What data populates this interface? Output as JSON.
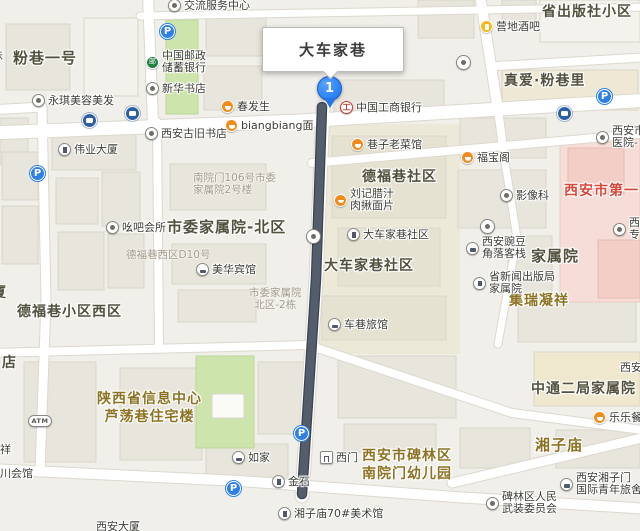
{
  "map": {
    "callout": {
      "text": "大车家巷"
    },
    "marker": {
      "number": "1"
    },
    "colors": {
      "route": "#535d6b",
      "marker_blue": "#2f86f6",
      "parking_blue": "#2f7fe8",
      "bus_blue": "#2c5fa4",
      "food_orange": "#f08c1e",
      "beer_yellow": "#f3b91d",
      "icbc_red": "#c23b31",
      "psbc_green": "#1e7f3e",
      "area_dark": "#53513e",
      "area_gold": "#8d7424",
      "hospital_red": "#d6473c",
      "addr_gray": "#a29c90",
      "park_green": "#cde4ad",
      "hospital_pink": "#f7ddd7"
    },
    "areas": [
      {
        "name": "fenxiang-yihao",
        "style": "dark",
        "size": 15,
        "x": 13,
        "y": 49,
        "lines": [
          "粉巷一号"
        ]
      },
      {
        "name": "sheng-chubanshe-xiaoqu",
        "style": "dark",
        "size": 14,
        "x": 542,
        "y": 4,
        "lines": [
          "省出版社小区"
        ]
      },
      {
        "name": "zhenai-fenxiangli",
        "style": "dark",
        "size": 14,
        "x": 504,
        "y": 73,
        "lines": [
          "真爱·粉巷里"
        ]
      },
      {
        "name": "defuxiang-shequ",
        "style": "dark",
        "size": 14,
        "x": 362,
        "y": 169,
        "lines": [
          "德福巷社区"
        ]
      },
      {
        "name": "shiwei-jiashuyuan-beiqu",
        "style": "dark",
        "size": 15,
        "x": 167,
        "y": 218,
        "lines": [
          "市委家属院-北区"
        ]
      },
      {
        "name": "defuxiang-xiaoqu-xiqu",
        "style": "dark",
        "size": 14,
        "x": 17,
        "y": 304,
        "lines": [
          "德福巷小区西区"
        ]
      },
      {
        "name": "dachejiaxiang-shequ",
        "style": "dark",
        "size": 14,
        "x": 324,
        "y": 258,
        "lines": [
          "大车家巷社区"
        ]
      },
      {
        "name": "jiashuyuan",
        "style": "dark",
        "size": 15,
        "x": 531,
        "y": 247,
        "lines": [
          "家属院"
        ]
      },
      {
        "name": "jirui-ningxiang",
        "style": "gold",
        "size": 14,
        "x": 509,
        "y": 293,
        "lines": [
          "集瑞凝祥"
        ]
      },
      {
        "name": "shanxisheng-xinxi-zhongxin",
        "style": "gold",
        "size": 14,
        "x": 97,
        "y": 391,
        "align": "center",
        "lines": [
          "陕西省信息中心",
          "芦荡巷住宅楼"
        ]
      },
      {
        "name": "beilinqu-youeryuan",
        "style": "gold",
        "size": 14,
        "x": 362,
        "y": 448,
        "lines": [
          "西安市碑林区",
          "南院门幼儿园"
        ]
      },
      {
        "name": "xiangzimiao",
        "style": "gold",
        "size": 15,
        "x": 535,
        "y": 436,
        "lines": [
          "湘子庙"
        ]
      },
      {
        "name": "zhongtong-erju-jiashuyuan",
        "style": "dark",
        "size": 14,
        "x": 531,
        "y": 381,
        "lines": [
          "中通二局家属院"
        ]
      },
      {
        "name": "xianshi-diyi-yiyuan",
        "style": "red",
        "size": 14,
        "x": 564,
        "y": 183,
        "lines": [
          "西安市第一"
        ]
      },
      {
        "name": "sha-partial",
        "style": "dark",
        "size": 14,
        "x": -8,
        "y": 285,
        "lines": [
          "厦"
        ]
      },
      {
        "name": "dian-partial",
        "style": "dark",
        "size": 14,
        "x": 2,
        "y": 355,
        "lines": [
          "店"
        ]
      }
    ],
    "pois": [
      {
        "name": "jiaoliu-fuwu-zhongxin",
        "icon": "dot",
        "x": 168,
        "y": -1,
        "lines": [
          "交流服务中心"
        ]
      },
      {
        "name": "zhongguo-youzheng-chuxu-yinhang",
        "icon": "bank-psbc",
        "x": 146,
        "y": 50,
        "lines": [
          "中国邮政",
          "储蓄银行"
        ]
      },
      {
        "name": "xinhua-shudian",
        "icon": "dot",
        "x": 146,
        "y": 82,
        "lines": [
          "新华书店"
        ]
      },
      {
        "name": "yongqi-meirong-meifa",
        "icon": "dot",
        "x": 32,
        "y": 94,
        "lines": [
          "永琪美容美发"
        ]
      },
      {
        "name": "chunfasheng",
        "icon": "food",
        "x": 221,
        "y": 100,
        "lines": [
          "春发生"
        ]
      },
      {
        "name": "biangbiang-mian",
        "icon": "food",
        "x": 225,
        "y": 119,
        "lines": [
          "biangbiang面"
        ]
      },
      {
        "name": "xian-gujiu-shudian",
        "icon": "dot",
        "x": 145,
        "y": 127,
        "lines": [
          "西安古旧书店"
        ]
      },
      {
        "name": "weiye-dasha",
        "icon": "bldg",
        "x": 58,
        "y": 143,
        "lines": [
          "伟业大厦"
        ]
      },
      {
        "name": "yingdi-jiuba",
        "icon": "beer",
        "x": 480,
        "y": 20,
        "lines": [
          "营地酒吧"
        ]
      },
      {
        "name": "zhongguo-gongshang-yinhang",
        "icon": "bank-icbc",
        "x": 340,
        "y": 101,
        "lines": [
          "中国工商银行"
        ]
      },
      {
        "name": "xiangzi-laocaiguan",
        "icon": "food",
        "x": 351,
        "y": 138,
        "lines": [
          "巷子老菜馆"
        ]
      },
      {
        "name": "fubaoge",
        "icon": "food",
        "x": 461,
        "y": 151,
        "lines": [
          "福宝阁"
        ]
      },
      {
        "name": "liuji-lazhi-roujiu-mianpian",
        "icon": "food",
        "x": 334,
        "y": 188,
        "lines": [
          "刘记腊汁",
          "肉揪面片"
        ]
      },
      {
        "name": "yingxiangke",
        "icon": "dot",
        "x": 500,
        "y": 189,
        "lines": [
          "影像科"
        ]
      },
      {
        "name": "yaoba-huisuo",
        "icon": "dot",
        "x": 106,
        "y": 221,
        "lines": [
          "吆吧会所"
        ]
      },
      {
        "name": "meihua-binguan",
        "icon": "hotel",
        "x": 196,
        "y": 263,
        "lines": [
          "美华宾馆"
        ]
      },
      {
        "name": "dachejiaxiang-shequ-poi",
        "icon": "bldg",
        "x": 347,
        "y": 228,
        "lines": [
          "大车家巷社区"
        ]
      },
      {
        "name": "xian-wandou-jiaoluo-kezhan",
        "icon": "hotel",
        "x": 466,
        "y": 236,
        "lines": [
          "西安豌豆",
          "角落客栈"
        ]
      },
      {
        "name": "sheng-xinwen-chubanju-jiashuyuan",
        "icon": "bldg",
        "x": 473,
        "y": 271,
        "lines": [
          "省新闻出版局",
          "家属院"
        ]
      },
      {
        "name": "chexiang-lvguan",
        "icon": "hotel",
        "x": 328,
        "y": 318,
        "lines": [
          "车巷旅馆"
        ]
      },
      {
        "name": "rujia",
        "icon": "hotel",
        "x": 232,
        "y": 451,
        "lines": [
          "如家"
        ]
      },
      {
        "name": "jinshi",
        "icon": "bldg",
        "x": 272,
        "y": 475,
        "lines": [
          "金石"
        ]
      },
      {
        "name": "ximen",
        "icon": "gate",
        "x": 320,
        "y": 451,
        "lines": [
          "西门"
        ]
      },
      {
        "name": "xiangzimiao-70-meishuguan",
        "icon": "bldg",
        "x": 278,
        "y": 507,
        "lines": [
          "湘子庙70#美术馆"
        ]
      },
      {
        "name": "beilinqu-renmin-wuzhuang-weiyuanhui",
        "icon": "dot",
        "x": 486,
        "y": 491,
        "lines": [
          "碑林区人民",
          "武装委员会"
        ]
      },
      {
        "name": "xian-xiangzimen-guoji-qingnian-lvshe",
        "icon": "hotel",
        "x": 560,
        "y": 472,
        "lines": [
          "西安湘子门",
          "国际青年旅舍"
        ]
      },
      {
        "name": "lele-can",
        "icon": "food",
        "x": 593,
        "y": 411,
        "lines": [
          "乐乐餐"
        ]
      },
      {
        "name": "xianshi-yiyuan-small",
        "icon": "dot",
        "x": 596,
        "y": 125,
        "lines": [
          "西安市",
          "医院-"
        ]
      },
      {
        "name": "xi-zhuan-partial",
        "icon": "dot",
        "x": 613,
        "y": 217,
        "lines": [
          "西",
          "专"
        ]
      },
      {
        "name": "xian-partial",
        "x": 620,
        "y": 362,
        "lines": [
          "西安"
        ]
      },
      {
        "name": "wei-partial",
        "x": -8,
        "y": 50,
        "lines": [
          "味"
        ]
      },
      {
        "name": "xiang-partial",
        "x": 0,
        "y": 444,
        "lines": [
          "祥"
        ]
      },
      {
        "name": "chuan-huiguan-partial",
        "x": 0,
        "y": 468,
        "lines": [
          "川会馆"
        ]
      },
      {
        "name": "xian-dasha-partial",
        "x": 96,
        "y": 521,
        "lines": [
          "西安大厦"
        ]
      }
    ],
    "addrs": [
      {
        "name": "nanyuanmen-106-hao",
        "x": 193,
        "y": 172,
        "lines": [
          "南院门106号市委",
          "家属院2号楼"
        ]
      },
      {
        "name": "defuxiang-xiqu-d10",
        "x": 126,
        "y": 249,
        "lines": [
          "德福巷西区D10号"
        ]
      },
      {
        "name": "beiqu-2-dong",
        "x": 249,
        "y": 287,
        "align": "center",
        "lines": [
          "市委家属院",
          "北区-2栋"
        ]
      }
    ],
    "icons": [
      {
        "name": "parking-top-left",
        "type": "parking",
        "x": 160,
        "y": 24
      },
      {
        "name": "parking-left",
        "type": "parking",
        "x": 30,
        "y": 166
      },
      {
        "name": "parking-right",
        "type": "parking",
        "x": 597,
        "y": 89
      },
      {
        "name": "parking-on-route",
        "type": "parking",
        "x": 294,
        "y": 426
      },
      {
        "name": "parking-bottom",
        "type": "parking",
        "x": 226,
        "y": 481
      },
      {
        "name": "bus-stop-left-1",
        "type": "bus",
        "x": 82,
        "y": 113
      },
      {
        "name": "bus-stop-left-2",
        "type": "bus",
        "x": 125,
        "y": 106
      },
      {
        "name": "bus-stop-right",
        "type": "bus",
        "x": 557,
        "y": 106
      },
      {
        "name": "poi-dot-route",
        "type": "dot",
        "x": 306,
        "y": 229
      },
      {
        "name": "poi-dot-center",
        "type": "dot",
        "x": 480,
        "y": 219
      },
      {
        "name": "poi-dot-top",
        "type": "dot",
        "x": 456,
        "y": 55
      },
      {
        "name": "atm",
        "type": "atm",
        "x": 28,
        "y": 415,
        "text": "ATM"
      }
    ]
  }
}
